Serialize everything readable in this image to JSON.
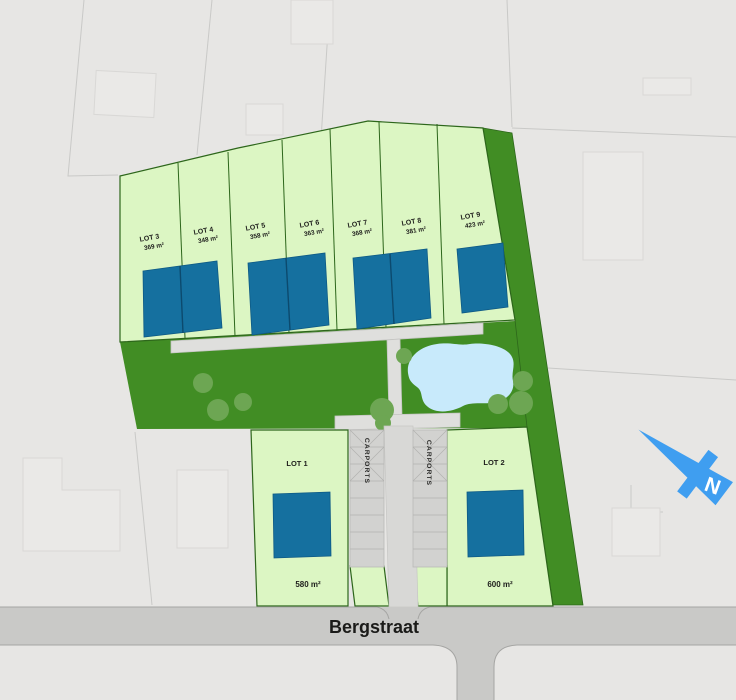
{
  "street": {
    "label": "Bergstraat"
  },
  "north": {
    "label": "N"
  },
  "carports": {
    "left_label": "CARPORTS",
    "right_label": "CARPORTS"
  },
  "lots_top": [
    {
      "name": "LOT 3",
      "area": "369 m²"
    },
    {
      "name": "LOT 4",
      "area": "348 m²"
    },
    {
      "name": "LOT 5",
      "area": "358 m²"
    },
    {
      "name": "LOT 6",
      "area": "363 m²"
    },
    {
      "name": "LOT 7",
      "area": "368 m²"
    },
    {
      "name": "LOT 8",
      "area": "381 m²"
    },
    {
      "name": "LOT 9",
      "area": "423 m²"
    }
  ],
  "lots_bottom": [
    {
      "name": "LOT 1",
      "area": "580 m²"
    },
    {
      "name": "LOT 2",
      "area": "600 m²"
    }
  ],
  "colors": {
    "background": "#e7e6e4",
    "lot_green": "#dcf6c3",
    "lot_border": "#2d661b",
    "garden_green": "#418d24",
    "house_blue": "#15709f",
    "pond_blue": "#c8eafb",
    "tree_green": "#6da653",
    "path_gray": "#dfdfdd",
    "carport_gray": "#d2d2d0",
    "street_gray": "#c9c9c7",
    "north_arrow_blue": "#3f9ef0",
    "label_text": "#1e1e1c"
  }
}
